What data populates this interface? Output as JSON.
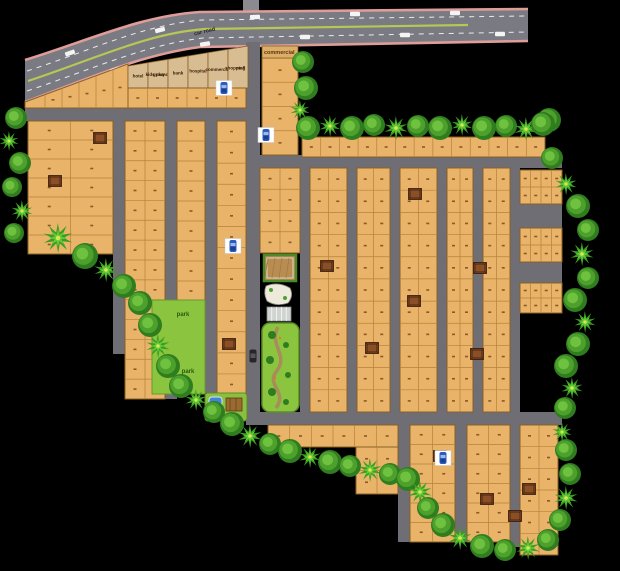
{
  "palette": {
    "bg": "#000000",
    "road": "#6e6e74",
    "main_road": "#7a7a82",
    "road_edge": "#df9d99",
    "median": "#b8c654",
    "plot": "#e9b469",
    "plot_border": "#b5823a",
    "block_border": "#8a5f25",
    "special_plot": "#d9bd92",
    "park": "#8bc43e",
    "tree_dark": "#2f7d1f",
    "tree_mid": "#4da02c",
    "tree_light": "#6fc23f",
    "palm": "#3a9e1f",
    "palm_light": "#66c83c",
    "palm_center": "#d8e84a",
    "house": "#6b3a1a",
    "house_inner": "#8a4f24",
    "car_blue": "#2a5cc0",
    "pool": "#3f86d8",
    "white": "#f4f4f4",
    "mark": "#6b3a10",
    "label_dark": "#3a2206",
    "park_label": "#2a5a10",
    "road_label": "#26262a"
  },
  "labels": {
    "road_label": "car road",
    "commercial_label": "commercial",
    "park_labels": [
      "park",
      "park"
    ]
  },
  "special_plots": [
    [
      "hotel"
    ],
    [
      "kids play",
      "ground"
    ],
    [
      "bank"
    ],
    [
      "hospital"
    ],
    [
      "commercial"
    ],
    [
      "shopping",
      "mall"
    ]
  ],
  "map": {
    "width": 620,
    "height": 571,
    "main_road": {
      "outline": "M25,60 C90,40 140,16 200,12 L528,9 L528,41 L200,47 C140,55 90,78 25,102 Z",
      "edge_top": "M25,60 C90,40 140,16 200,12 L528,9",
      "edge_bottom": "M25,102 C90,78 140,55 200,47 L528,41",
      "median": "M28,81 C95,59 148,33 205,29 L468,25",
      "dash1": "M27,71 C92,50 142,25 202,20 L528,16",
      "dash2": "M27,91 C93,69 144,45 203,38 L528,32",
      "stub": [
        243,
        0,
        16,
        12
      ],
      "cars": [
        [
          70,
          53,
          -19
        ],
        [
          160,
          30,
          -15
        ],
        [
          255,
          17,
          -3
        ],
        [
          355,
          14,
          0
        ],
        [
          455,
          13,
          0
        ],
        [
          115,
          70,
          -18
        ],
        [
          205,
          44,
          -9
        ],
        [
          305,
          37,
          0
        ],
        [
          405,
          35,
          0
        ],
        [
          500,
          34,
          0
        ]
      ]
    },
    "roads": [
      [
        246,
        42,
        14,
        383
      ],
      [
        25,
        108,
        221,
        13
      ],
      [
        113,
        121,
        12,
        233
      ],
      [
        165,
        121,
        12,
        278
      ],
      [
        205,
        121,
        12,
        272
      ],
      [
        260,
        155,
        302,
        13
      ],
      [
        300,
        168,
        10,
        244
      ],
      [
        347,
        168,
        10,
        244
      ],
      [
        390,
        168,
        10,
        244
      ],
      [
        437,
        168,
        10,
        244
      ],
      [
        473,
        168,
        10,
        244
      ],
      [
        510,
        168,
        10,
        244
      ],
      [
        520,
        204,
        42,
        24
      ],
      [
        520,
        262,
        42,
        21
      ],
      [
        246,
        412,
        316,
        13
      ],
      [
        398,
        425,
        12,
        117
      ],
      [
        455,
        425,
        12,
        117
      ],
      [
        510,
        425,
        10,
        122
      ]
    ],
    "slant_row": {
      "path": "M25,102 L128,64 L128,108 L25,108 Z",
      "lines": [
        45,
        62,
        79,
        96,
        113
      ],
      "mark_xs": [
        53,
        70,
        87,
        104,
        120
      ]
    },
    "special_strip": {
      "x0": 128,
      "cell_w": 20,
      "count": 6,
      "top_y_start": 66,
      "top_y_end": 46,
      "bottom": 88
    },
    "blocks": [
      [
        28,
        121,
        85,
        133,
        7,
        2
      ],
      [
        125,
        121,
        40,
        278,
        14,
        2
      ],
      [
        177,
        121,
        28,
        180,
        9,
        1
      ],
      [
        217,
        121,
        29,
        274,
        13,
        1
      ],
      [
        128,
        88,
        118,
        20,
        1,
        6
      ],
      [
        262,
        58,
        36,
        97,
        4,
        1
      ],
      [
        302,
        137,
        243,
        20,
        1,
        13
      ],
      [
        260,
        168,
        40,
        85,
        4,
        2
      ],
      [
        310,
        168,
        37,
        244,
        11,
        2
      ],
      [
        357,
        168,
        33,
        244,
        11,
        2
      ],
      [
        400,
        168,
        37,
        244,
        11,
        2
      ],
      [
        447,
        168,
        26,
        244,
        11,
        2
      ],
      [
        483,
        168,
        27,
        244,
        11,
        2
      ],
      [
        520,
        170,
        42,
        34,
        2,
        4
      ],
      [
        520,
        228,
        42,
        34,
        2,
        4
      ],
      [
        520,
        283,
        42,
        30,
        2,
        4
      ],
      [
        268,
        425,
        130,
        22,
        1,
        6
      ],
      [
        356,
        447,
        42,
        47,
        2,
        2
      ],
      [
        410,
        425,
        45,
        117,
        6,
        2
      ],
      [
        467,
        425,
        43,
        117,
        6,
        2
      ],
      [
        520,
        425,
        38,
        130,
        6,
        2
      ]
    ],
    "amenities": {
      "court": [
        264,
        255,
        32,
        26
      ],
      "clubhouse": [
        264,
        284,
        30,
        20
      ],
      "court2": [
        267,
        307,
        24,
        14
      ],
      "garden": [
        262,
        323,
        37,
        89
      ],
      "garden_path": "M278,327 C268,345 290,355 276,372 C266,385 288,392 276,408",
      "garden_trees": [
        [
          272,
          335,
          4
        ],
        [
          286,
          345,
          3
        ],
        [
          270,
          360,
          4
        ],
        [
          288,
          375,
          3
        ],
        [
          272,
          392,
          4
        ],
        [
          286,
          402,
          3
        ]
      ],
      "garden_dots": [
        [
          280,
          338
        ],
        [
          275,
          378
        ]
      ],
      "park": [
        152,
        300,
        53,
        94
      ],
      "kids": [
        205,
        393,
        42,
        28
      ],
      "pool": [
        209,
        397,
        13,
        17
      ],
      "deck": [
        226,
        398,
        16,
        13
      ]
    },
    "park_label_pos": [
      [
        183,
        316
      ],
      [
        188,
        373
      ]
    ],
    "commercial_header": [
      262,
      46,
      36,
      12
    ],
    "commercial_label_pos": [
      264,
      54
    ],
    "road_label_pos": [
      205,
      33,
      -14
    ],
    "trees": [
      [
        16,
        118,
        11,
        0
      ],
      [
        9,
        141,
        10,
        1
      ],
      [
        20,
        163,
        11,
        0
      ],
      [
        12,
        187,
        10,
        0
      ],
      [
        22,
        211,
        11,
        1
      ],
      [
        14,
        233,
        10,
        0
      ],
      [
        58,
        238,
        15,
        1
      ],
      [
        85,
        256,
        13,
        0
      ],
      [
        106,
        270,
        12,
        1
      ],
      [
        124,
        286,
        12,
        0
      ],
      [
        140,
        303,
        12,
        0
      ],
      [
        150,
        325,
        12,
        0
      ],
      [
        158,
        346,
        12,
        1
      ],
      [
        168,
        366,
        12,
        0
      ],
      [
        181,
        386,
        12,
        0
      ],
      [
        196,
        400,
        11,
        1
      ],
      [
        214,
        412,
        11,
        0
      ],
      [
        232,
        424,
        12,
        0
      ],
      [
        250,
        436,
        12,
        1
      ],
      [
        270,
        444,
        11,
        0
      ],
      [
        290,
        451,
        12,
        0
      ],
      [
        310,
        457,
        11,
        1
      ],
      [
        330,
        462,
        12,
        0
      ],
      [
        350,
        466,
        11,
        0
      ],
      [
        370,
        470,
        12,
        1
      ],
      [
        390,
        474,
        11,
        0
      ],
      [
        408,
        479,
        12,
        0
      ],
      [
        420,
        492,
        12,
        1
      ],
      [
        428,
        508,
        11,
        0
      ],
      [
        443,
        525,
        12,
        0
      ],
      [
        460,
        538,
        12,
        1
      ],
      [
        482,
        546,
        12,
        0
      ],
      [
        505,
        550,
        11,
        0
      ],
      [
        528,
        548,
        12,
        1
      ],
      [
        548,
        540,
        11,
        0
      ],
      [
        560,
        520,
        11,
        0
      ],
      [
        566,
        498,
        12,
        1
      ],
      [
        570,
        474,
        11,
        0
      ],
      [
        566,
        450,
        11,
        0
      ],
      [
        562,
        432,
        10,
        1
      ],
      [
        565,
        408,
        11,
        0
      ],
      [
        572,
        388,
        11,
        1
      ],
      [
        566,
        366,
        12,
        0
      ],
      [
        578,
        344,
        12,
        0
      ],
      [
        585,
        322,
        11,
        1
      ],
      [
        575,
        300,
        12,
        0
      ],
      [
        588,
        278,
        11,
        0
      ],
      [
        582,
        254,
        12,
        1
      ],
      [
        588,
        230,
        11,
        0
      ],
      [
        578,
        206,
        12,
        0
      ],
      [
        566,
        184,
        11,
        1
      ],
      [
        552,
        158,
        11,
        0
      ],
      [
        549,
        120,
        12,
        0
      ],
      [
        308,
        128,
        12,
        0
      ],
      [
        330,
        126,
        11,
        1
      ],
      [
        352,
        128,
        12,
        0
      ],
      [
        374,
        125,
        11,
        0
      ],
      [
        396,
        128,
        12,
        1
      ],
      [
        418,
        126,
        11,
        0
      ],
      [
        440,
        128,
        12,
        0
      ],
      [
        462,
        125,
        11,
        1
      ],
      [
        484,
        128,
        12,
        0
      ],
      [
        506,
        126,
        11,
        0
      ],
      [
        526,
        129,
        12,
        1
      ],
      [
        543,
        124,
        12,
        0
      ],
      [
        303,
        62,
        11,
        0
      ],
      [
        306,
        88,
        12,
        0
      ],
      [
        300,
        110,
        10,
        1
      ]
    ],
    "houses": [
      [
        100,
        138
      ],
      [
        55,
        181
      ],
      [
        415,
        194
      ],
      [
        327,
        266
      ],
      [
        480,
        268
      ],
      [
        414,
        301
      ],
      [
        477,
        354
      ],
      [
        372,
        348
      ],
      [
        440,
        456
      ],
      [
        529,
        489
      ],
      [
        487,
        499
      ],
      [
        515,
        516
      ],
      [
        229,
        344
      ]
    ],
    "cars": [
      [
        224,
        88
      ],
      [
        266,
        135
      ],
      [
        233,
        246
      ],
      [
        443,
        458
      ]
    ],
    "dark_cars": [
      [
        253,
        356
      ]
    ]
  }
}
